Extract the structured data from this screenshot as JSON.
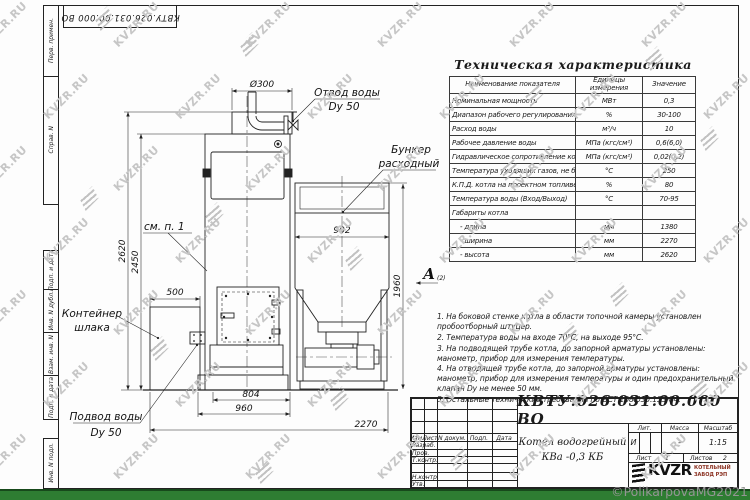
{
  "sheet": {
    "designation_top": "КВТУ.026.031.00.000 ВО"
  },
  "margin": [
    {
      "label": "Перв. примен."
    },
    {
      "label": "Справ. N"
    },
    {
      "label": "Подп. и дата"
    },
    {
      "label": "Инв. N дубл."
    },
    {
      "label": "Взам. инв. N"
    },
    {
      "label": "Подп. и дата"
    },
    {
      "label": "Инв. N подл."
    }
  ],
  "tech_table": {
    "title": "Техническая характеристика",
    "headers": [
      "Наименование показателя",
      "Единицы измерения",
      "Значение"
    ],
    "rows": [
      {
        "n": "Номинальная мощность",
        "u": "МВт",
        "v": "0,3"
      },
      {
        "n": "Диапазон рабочего регулирования",
        "u": "%",
        "v": "30-100"
      },
      {
        "n": "Расход воды",
        "u": "м³/ч",
        "v": "10"
      },
      {
        "n": "Рабочее давление воды",
        "u": "МПа (кгс/см²)",
        "v": "0,6(6,0)"
      },
      {
        "n": "Гидравлическое сопротивление котла",
        "u": "МПа (кгс/см²)",
        "v": "0,02(0,2)"
      },
      {
        "n": "Температура уходящих газов, не более",
        "u": "°С",
        "v": "250"
      },
      {
        "n": "К.П.Д. котла на проектном топливе",
        "u": "%",
        "v": "80"
      },
      {
        "n": "Температура воды (Вход/Выход)",
        "u": "°С",
        "v": "70-95"
      },
      {
        "n": "Габариты котла",
        "u": "",
        "v": ""
      },
      {
        "n": "- длина",
        "u": "мм",
        "v": "1380"
      },
      {
        "n": "- ширина",
        "u": "мм",
        "v": "2270"
      },
      {
        "n": "- высота",
        "u": "мм",
        "v": "2620"
      }
    ]
  },
  "notes": [
    "1. На боковой стенке котла в области топочной камеры установлен пробоотборный штуцер.",
    "2. Температура воды на входе 70°С, на выходе 95°С.",
    "3. На подводящей трубе котла, до запорной арматуры установлены: манометр, прибор для измерения температуры.",
    "4. На отводящей трубе котла, до запорной арматуры установлены: манометр, прибор для измерения температуры и один предохранительный клапан Dу не менее 50 мм.",
    "5. Остальные технические требования по ОСТ 108.030.133-84."
  ],
  "drawing": {
    "labels": {
      "outlet_l1": "Отвод воды",
      "outlet_l2": "Dу 50",
      "bunker_l1": "Бункер",
      "bunker_l2": "расходный",
      "container_l1": "Контейнер",
      "container_l2": "шлака",
      "inlet_l1": "Подвод воды",
      "inlet_l2": "Dу 50",
      "see_note": "см. п. 1",
      "view": "А",
      "view_sub": "(2)"
    },
    "dims": {
      "dia": "Ø300",
      "w902": "902",
      "h1960": "1960",
      "h2620": "2620",
      "h2450": "2450",
      "w500": "500",
      "w804": "804",
      "w960": "960",
      "w2270": "2270"
    }
  },
  "title_block": {
    "designation": "КВТУ.026.031.00.000 ВО",
    "doc_name_line1": "Котел водогрейный",
    "doc_name_line2": "КВа -0,3  КБ",
    "col_izm": "Изм.",
    "col_list": "Лист",
    "col_ndoc": "N докум.",
    "col_podp": "Подп.",
    "col_data": "Дата",
    "row_razrab": "Разраб.",
    "row_prov": "Пров.",
    "row_tkontr": "Т.контр.",
    "row_nkontr": "Н.контр.",
    "row_utv": "Утв.",
    "lit_label": "Лит.",
    "mass_label": "Масса",
    "scale_label": "Масштаб",
    "lit_value": "И",
    "mass_value": "-",
    "scale_value": "1:15",
    "sheet_label": "Лист",
    "sheet_value": "1",
    "sheets_label": "Листов",
    "sheets_value": "2",
    "logo_text": "KVZR",
    "company_line1": "КОТЕЛЬНЫЙ",
    "company_line2": "ЗАВОД РЭП"
  },
  "watermark": {
    "text": "KVZR.RU",
    "copyright": "©PolikarpovaMG2021"
  },
  "colors": {
    "accent_green": "#2e7d32",
    "line": "#222222",
    "watermark_gray": "#c6c6c6"
  }
}
